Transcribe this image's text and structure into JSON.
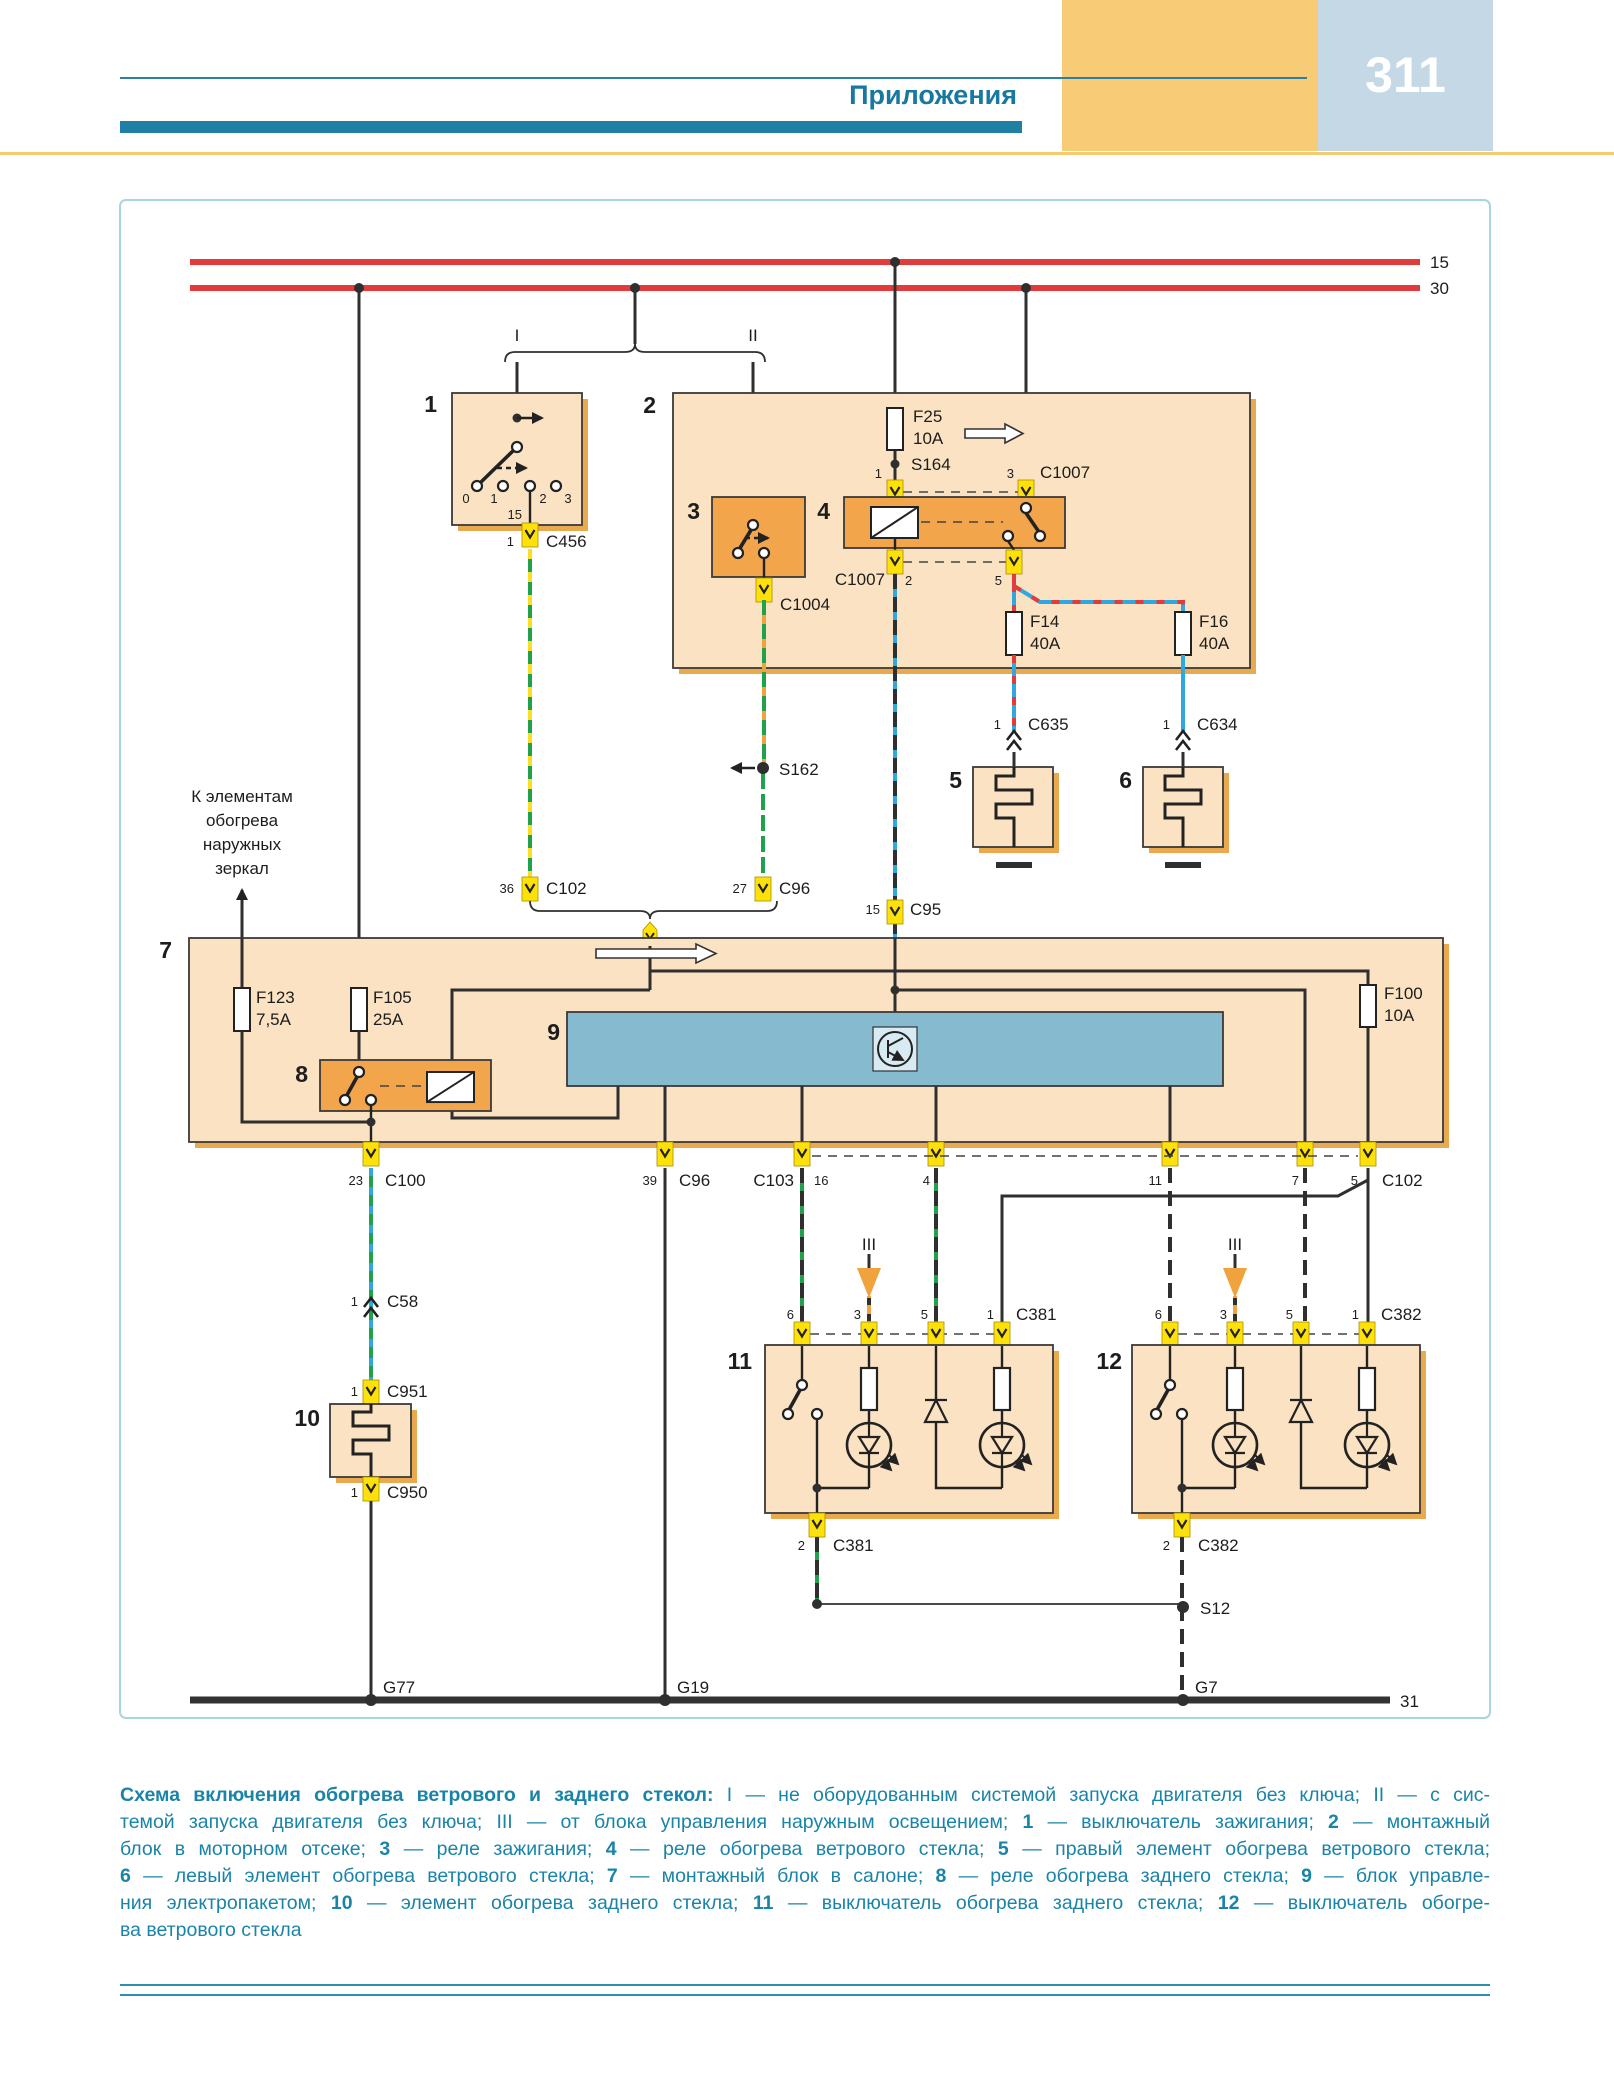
{
  "header": {
    "section": "Приложения",
    "page": "311"
  },
  "rails": {
    "r15": "15",
    "r30": "30",
    "gnd": "31"
  },
  "roman": {
    "i": "I",
    "ii": "II",
    "iii": "III"
  },
  "blocks": {
    "n1": "1",
    "n2": "2",
    "n3": "3",
    "n4": "4",
    "n5": "5",
    "n6": "6",
    "n7": "7",
    "n8": "8",
    "n9": "9",
    "n10": "10",
    "n11": "11",
    "n12": "12"
  },
  "fuses": {
    "f25n": "F25",
    "f25r": "10A",
    "f14n": "F14",
    "f14r": "40A",
    "f16n": "F16",
    "f16r": "40A",
    "f123n": "F123",
    "f123r": "7,5A",
    "f105n": "F105",
    "f105r": "25A",
    "f100n": "F100",
    "f100r": "10A"
  },
  "conn": {
    "c456": "C456",
    "c1007": "C1007",
    "c1004": "C1004",
    "c102": "C102",
    "c96": "C96",
    "c95": "C95",
    "c635": "C635",
    "c634": "C634",
    "c100": "C100",
    "c58": "C58",
    "c951": "C951",
    "c950": "C950",
    "c103": "C103",
    "c381": "C381",
    "c382": "C382"
  },
  "splice": {
    "s164": "S164",
    "s162": "S162",
    "s12": "S12"
  },
  "ground": {
    "g77": "G77",
    "g19": "G19",
    "g7": "G7"
  },
  "pins": {
    "p0": "0",
    "p1": "1",
    "p2": "2",
    "p3": "3",
    "p4": "4",
    "p5": "5",
    "p6": "6",
    "p7": "7",
    "p11": "11",
    "p15": "15",
    "p16": "16",
    "p23": "23",
    "p27": "27",
    "p36": "36",
    "p39": "39"
  },
  "note": {
    "l1": "К элементам",
    "l2": "обогрева",
    "l3": "наружных",
    "l4": "зеркал"
  },
  "colors": {
    "rail_red": "#E23B3B",
    "box_tan": "#FBE2C2",
    "box_orange": "#F2A54A",
    "box_blue": "#86BACF",
    "connector_yellow": "#FFE10A",
    "accent_teal": "#1F7FA5",
    "wire_green": "#1FA24B",
    "wire_blue": "#2FA8E0",
    "wire_orange": "#F0A23C",
    "wire_yellow": "#FFDD26"
  },
  "caption": {
    "l1b": "Схема включения обогрева ветрового и заднего стекол:",
    "l1a": " I — не оборудованным системой запуска двигателя без ключа; II — с сис-",
    "l2a": "темой запуска двигателя без ключа; III — от блока управления наружным освещением; ",
    "l2n1": "1",
    "l2b": " — выключатель зажигания; ",
    "l2n2": "2",
    "l2c": " — монтажный",
    "l3a": "блок в моторном отсеке; ",
    "l3n1": "3",
    "l3b": " — реле зажигания; ",
    "l3n2": "4",
    "l3c": " — реле обогрева ветрового стекла; ",
    "l3n3": "5",
    "l3d": " — правый элемент обогрева ветрового стекла;",
    "l4n1": "6",
    "l4a": " — левый элемент обогрева ветрового стекла; ",
    "l4n2": "7",
    "l4b": " — монтажный блок в салоне; ",
    "l4n3": "8",
    "l4c": " — реле обогрева заднего стекла; ",
    "l4n4": "9",
    "l4d": " — блок управле-",
    "l5a": "ния электропакетом; ",
    "l5n1": "10",
    "l5b": " — элемент обогрева заднего стекла; ",
    "l5n2": "11",
    "l5c": " — выключатель обогрева заднего стекла; ",
    "l5n3": "12",
    "l5d": " — выключатель обогре-",
    "l6a": "ва ветрового стекла"
  }
}
